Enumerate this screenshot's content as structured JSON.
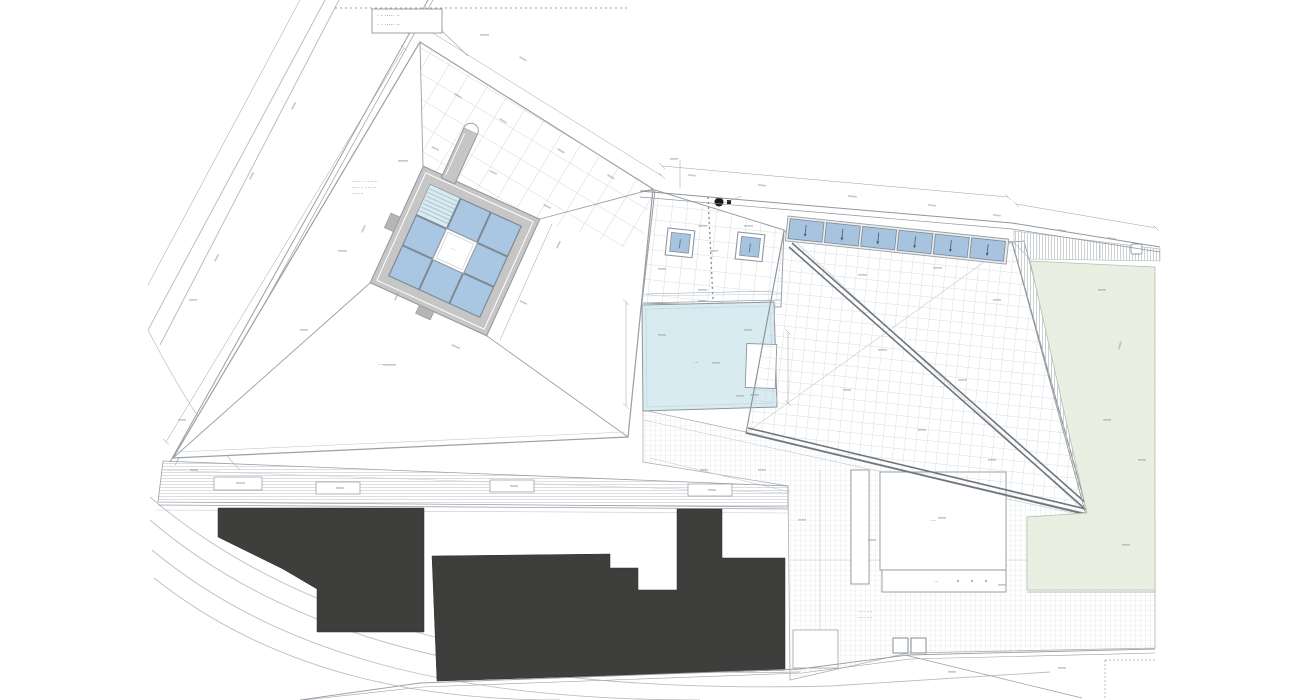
{
  "page": {
    "background": "#ffffff"
  },
  "palette": {
    "line": "#8f969c",
    "line_light": "#c3cad0",
    "frame_gray": "#c6c6c6",
    "glass_blue": "#a9c7e3",
    "louvre_blue": "#d9eaf0",
    "skylight_blue": "#a6c4e0",
    "pool_blue": "#d7ebf1",
    "lawn_green": "#eaefe1",
    "context_dark": "#3e3e3d",
    "hatch_gray": "#dcdfe2"
  },
  "plan": {
    "survey_note": {
      "line1": "· · ····· ··",
      "line2": "· · ····· ··"
    },
    "parapet_note": {
      "line1": "······ ·· ········",
      "line2": "····· ·· ···· ···",
      "line3": "········"
    },
    "labels": {
      "roof_label": "····",
      "pool_label": "···",
      "plaza_label_1": "····· ····",
      "plaza_label_2": "····· ····",
      "court_label": "···",
      "building_label": "····",
      "band_label": "···"
    },
    "counts": {
      "skylight_panels": 6,
      "courtyard_glass_grid": "3 x 3",
      "walkway_inserts": 4,
      "context_building_masses": 2,
      "roof_skylight_boxes": 2
    }
  }
}
